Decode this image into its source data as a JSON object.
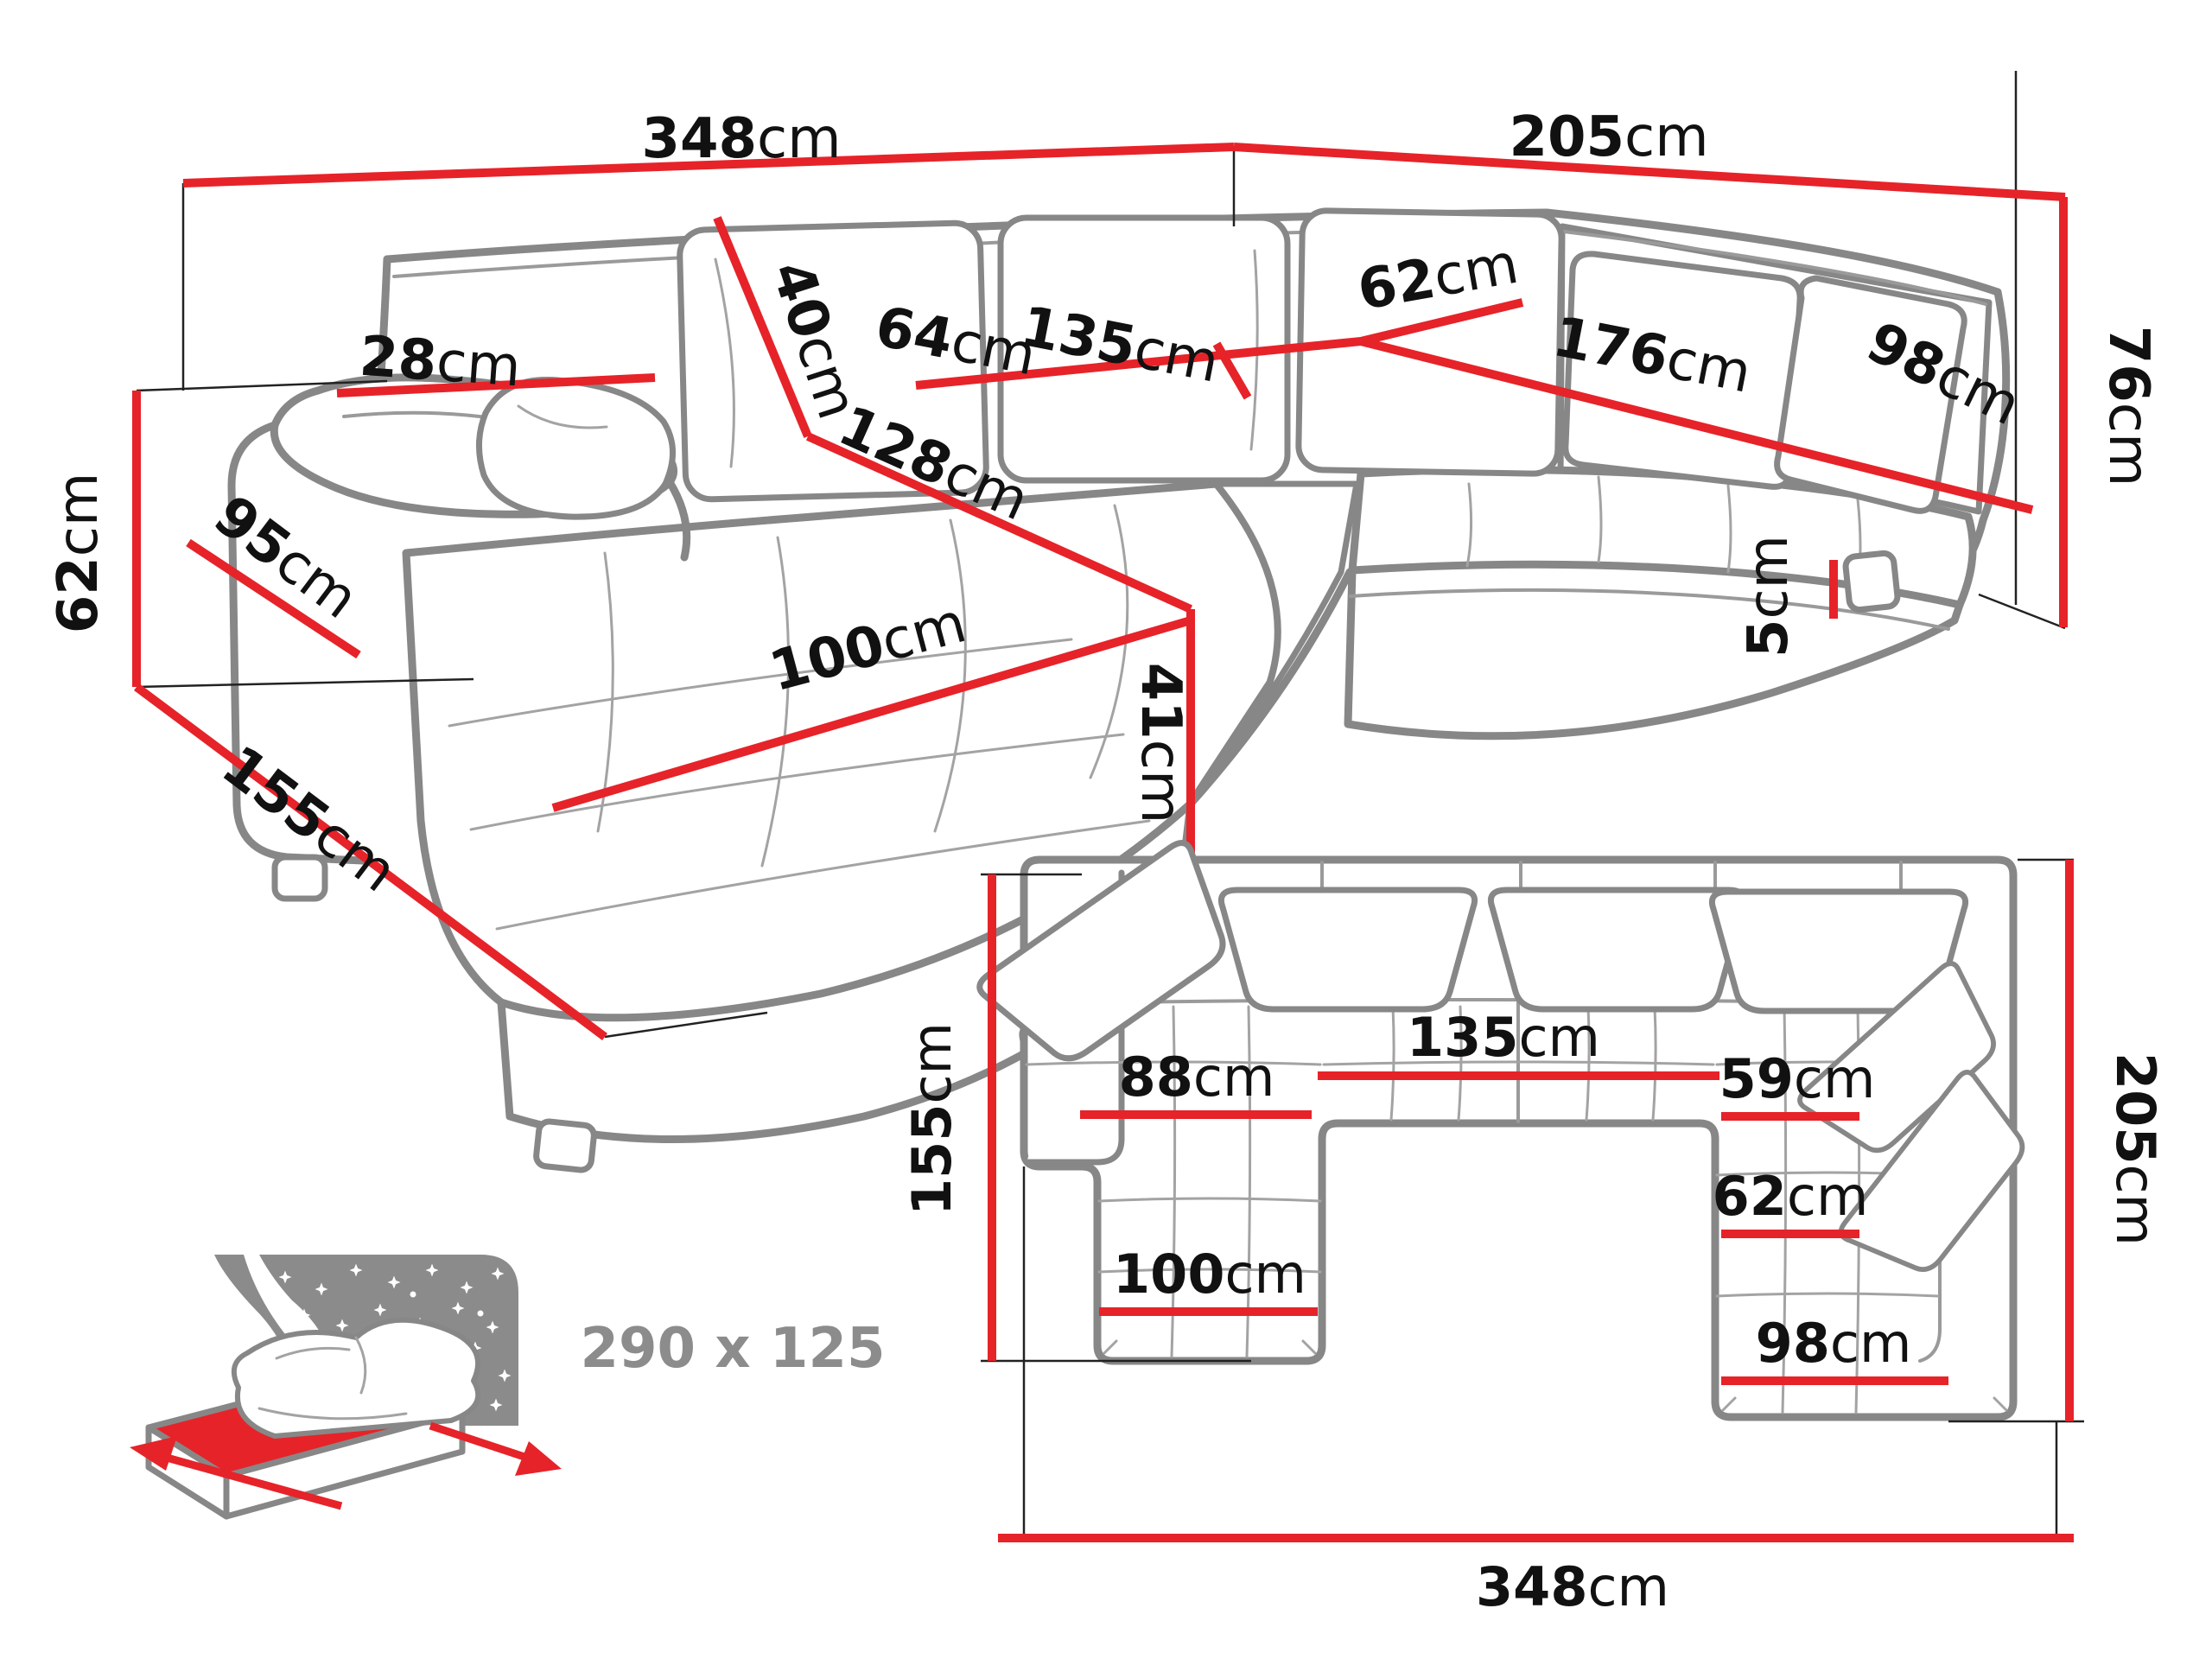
{
  "title": "U-shaped corner sofa dimension diagram",
  "colors": {
    "accent_red": "#e62329",
    "outline_gray": "#878787",
    "text_black": "#111111",
    "icon_gray": "#8c8c8c"
  },
  "perspective": {
    "width_left": {
      "v": "348",
      "u": "cm"
    },
    "width_right": {
      "v": "205",
      "u": "cm"
    },
    "height_side": {
      "v": "62",
      "u": "cm"
    },
    "depth_front": {
      "v": "155",
      "u": "cm"
    },
    "armrest_front": {
      "v": "95",
      "u": "cm"
    },
    "armrest_top": {
      "v": "28",
      "u": "cm"
    },
    "back_cushion": {
      "v": "40",
      "u": "cm"
    },
    "seat_depth": {
      "v": "64",
      "u": "cm"
    },
    "middle_width": {
      "v": "135",
      "u": "cm"
    },
    "chaise_length": {
      "v": "128",
      "u": "cm"
    },
    "chaise_width": {
      "v": "100",
      "u": "cm"
    },
    "seat_height": {
      "v": "41",
      "u": "cm"
    },
    "corner_seat": {
      "v": "62",
      "u": "cm"
    },
    "bench_length": {
      "v": "176",
      "u": "cm"
    },
    "bench_depth": {
      "v": "98",
      "u": "cm"
    },
    "back_height": {
      "v": "76",
      "u": "cm"
    },
    "leg_height": {
      "v": "5",
      "u": "cm"
    }
  },
  "plan": {
    "total_width": {
      "v": "348",
      "u": "cm"
    },
    "right_depth": {
      "v": "205",
      "u": "cm"
    },
    "left_depth": {
      "v": "155",
      "u": "cm"
    },
    "middle_width": {
      "v": "135",
      "u": "cm"
    },
    "left_seat": {
      "v": "88",
      "u": "cm"
    },
    "right_seat": {
      "v": "59",
      "u": "cm"
    },
    "right_corner_seat": {
      "v": "62",
      "u": "cm"
    },
    "left_chaise": {
      "v": "100",
      "u": "cm"
    },
    "right_chaise": {
      "v": "98",
      "u": "cm"
    }
  },
  "sleeping": {
    "size": "290 x 125"
  }
}
